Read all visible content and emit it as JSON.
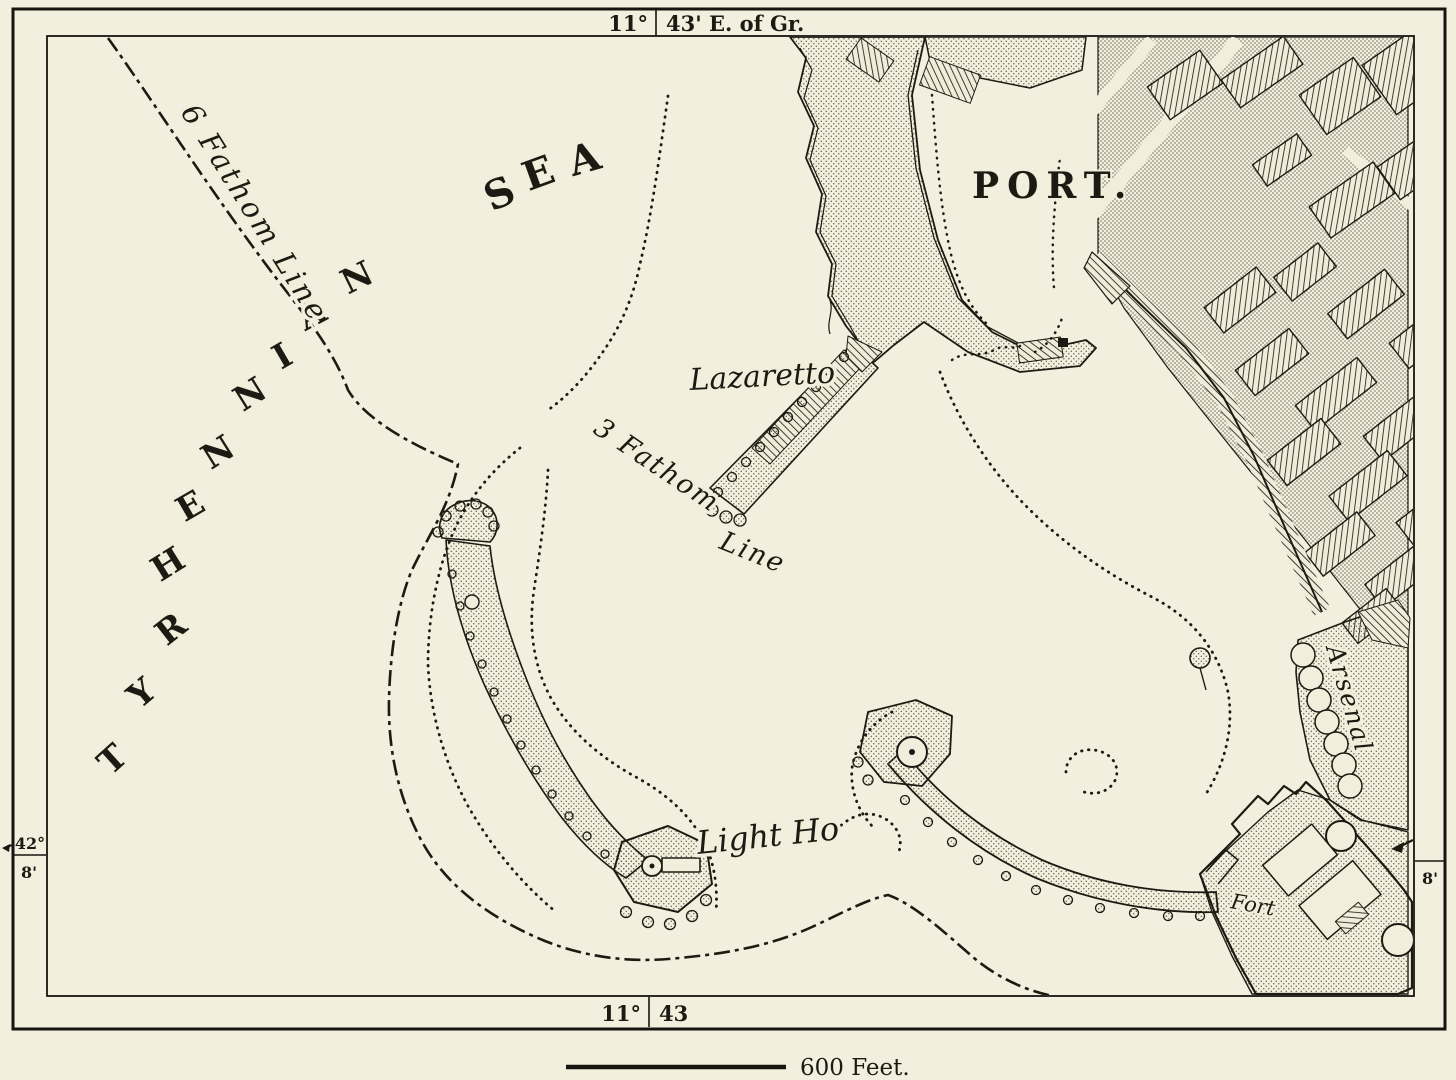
{
  "map": {
    "frame": {
      "top_longitude_degrees": "11°",
      "top_longitude_minutes": "43' E. of Gr.",
      "bottom_longitude_degrees": "11°",
      "bottom_longitude_minutes": "43",
      "left_latitude_degrees": "42°",
      "left_latitude_minutes": "8'",
      "right_latitude_minutes": "8'"
    },
    "labels": {
      "sea_letters": [
        "T",
        "Y",
        "R",
        "H",
        "E",
        "N",
        "N",
        "I",
        "A",
        "N"
      ],
      "sea_word": [
        "S",
        "E",
        "A"
      ],
      "port": "PORT.",
      "lazaretto": "Lazaretto",
      "lighthouse": "Light Ho",
      "arsenal": "Arsenal",
      "fort": "Fort",
      "six_fathom_line": "6 Fathom Line",
      "three_fathom": "3 Fathom",
      "three_fathom_line_word": "Line"
    },
    "scale_bar": {
      "label": "600 Feet."
    },
    "colors": {
      "paper": "#f1eedb",
      "ink": "#1c1b13"
    }
  }
}
